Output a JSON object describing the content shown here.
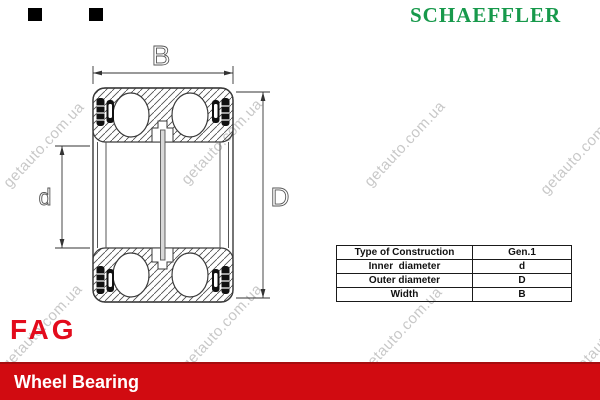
{
  "header": {
    "brand": "SCHAEFFLER",
    "brand_color": "#17994B"
  },
  "drawing": {
    "labels": {
      "width": "B",
      "inner_diameter": "d",
      "outer_diameter": "D"
    }
  },
  "spec_table": {
    "rows": [
      {
        "label": "Type of Construction",
        "value": "Gen.1"
      },
      {
        "label": "Inner  diameter",
        "value": "d"
      },
      {
        "label": "Outer diameter",
        "value": "D"
      },
      {
        "label": "Width",
        "value": "B"
      }
    ]
  },
  "footer": {
    "logo": "FAG",
    "logo_color": "#E30B1C",
    "banner_title": "Wheel Bearing",
    "banner_color": "#D10B11"
  },
  "watermark": {
    "text": "getauto.com.ua",
    "color": "#C8C8C8"
  }
}
